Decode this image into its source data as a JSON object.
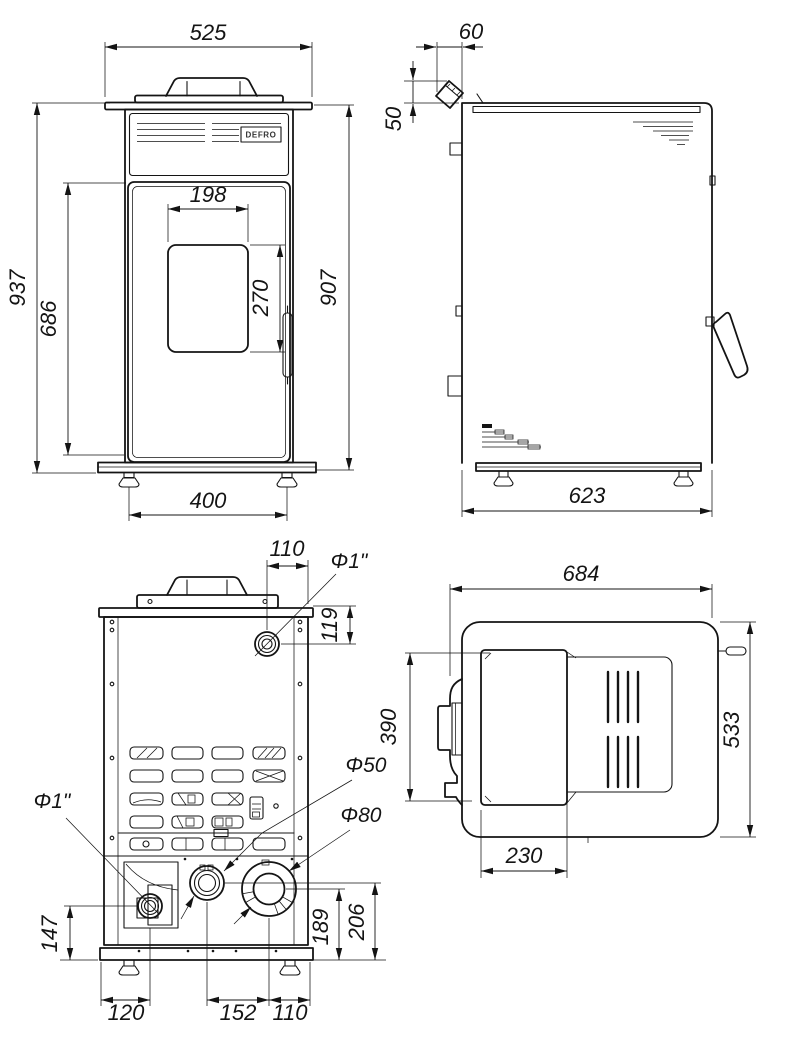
{
  "brand_logo": "DEFRO",
  "front_view": {
    "width": "525",
    "height_total": "937",
    "height_door": "686",
    "window_width": "198",
    "window_height": "270",
    "height_body": "907",
    "feet_span": "400"
  },
  "side_view": {
    "flue_offset": "60",
    "flue_drop": "50",
    "depth": "623"
  },
  "back_view": {
    "port_top_label": "Φ1\"",
    "port_top_offset": "110",
    "port_top_depth": "119",
    "port_mid_label": "Φ50",
    "flue_label": "Φ80",
    "port_left_label": "Φ1\"",
    "port_left_height": "147",
    "port_left_offset": "120",
    "port_spacing": "152",
    "flue_edge_offset": "110",
    "flue_height": "189",
    "port_mid_height": "206"
  },
  "top_view": {
    "width": "684",
    "depth": "533",
    "lid_depth": "390",
    "lid_width": "230"
  }
}
